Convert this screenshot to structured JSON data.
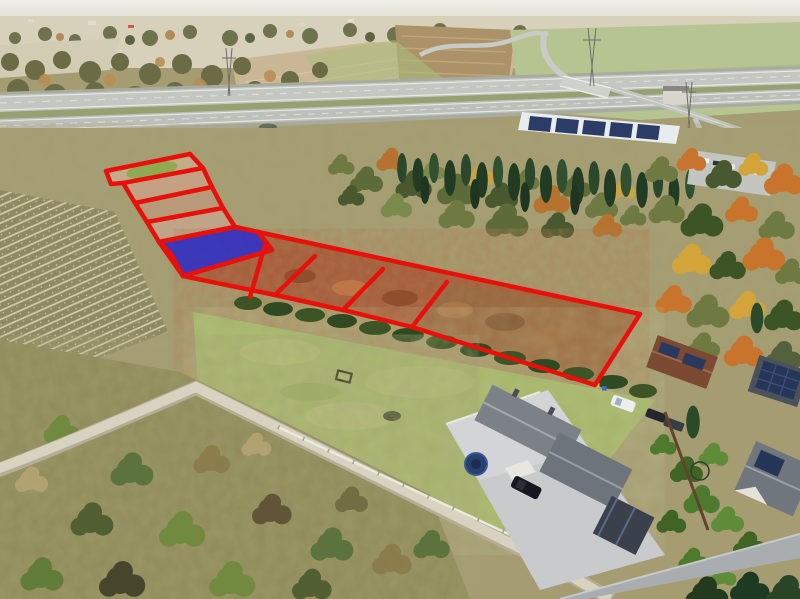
{
  "image": {
    "kind": "aerial-drone-photo",
    "description": "Aerial view of building plots for sale outlined in red, one plot highlighted in blue, beside a highway, scrubland, a mown green field and detached houses with solar-panel roofs",
    "width": 800,
    "height": 599
  },
  "overlay": {
    "outline_color": "#e8100a",
    "outline_width": 4.5,
    "highlight_fill": "#2121cd",
    "highlight_opacity": 0.8,
    "plots_total": 10,
    "plots_highlighted": 1,
    "upper_block": {
      "outline": "106,171 190,154 203,168 212,187 223,208 235,227 258,232 272,250 183,276 171,254 159,242 147,222 135,203 123,183 111,184",
      "dividers": [
        "123,183 203,168",
        "135,203 212,187",
        "147,222 223,208",
        "159,242 235,227"
      ]
    },
    "highlight_plot": "159,242 235,227 258,232 272,250 183,276",
    "chain": {
      "outline": "258,232 640,314 595,385 412,327 343,310 275,295 183,276 272,250",
      "dividers": [
        "265,245 250,297",
        "315,256 275,295",
        "383,269 343,310",
        "447,282 412,327"
      ]
    }
  },
  "scene": {
    "highway": "dual carriageway with grass median",
    "interchange": "overpass ramp and slip road",
    "warehouse": "hall with rooftop solar panels",
    "village": "distant tree line and village",
    "field": "plowed beige field",
    "scrub": "autumn scrubland and shrubs",
    "lawn": "mown green field",
    "access_road": "gravel access road",
    "houses": "detached houses, gray and brown roofs, rooftop solar panels",
    "details": "trampolines, parked cars, white fence, garden hedges"
  }
}
